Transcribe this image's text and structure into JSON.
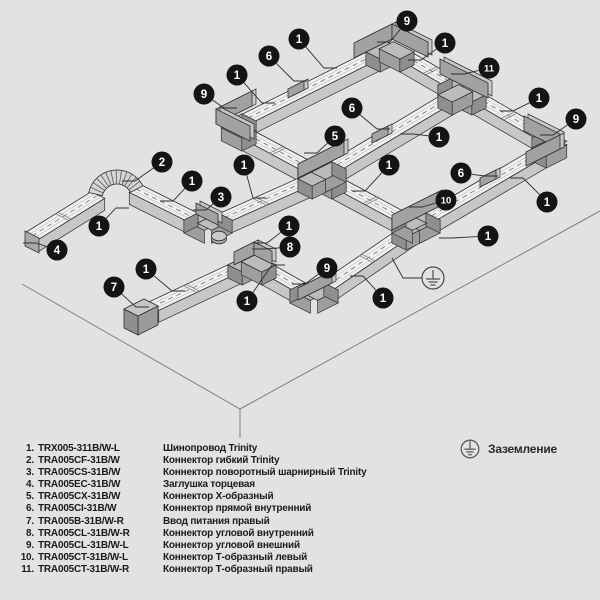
{
  "colors": {
    "bg": "#e2e2e0",
    "track_top": "#f0f0ee",
    "track_side": "#c7c7c5",
    "track_end": "#b2b2b0",
    "pad_top": "#bcbcba",
    "pad_side": "#9e9e9c",
    "pad_end": "#8f8f8d",
    "fin_front": "#a2a2a0",
    "fin_back": "#c8c8c6",
    "outline": "#2f2f2f",
    "dash": "#5e5e5c",
    "groove": "#aaaaa8",
    "plane_line": "#80807e",
    "callout_bg": "#141414",
    "callout_fg": "#ffffff",
    "ground_stroke": "#4a4a48",
    "legend_text": "#1b1b1b"
  },
  "diagram": {
    "plane": {
      "outline": [
        [
          22,
          284
        ],
        [
          240,
          409
        ],
        [
          600,
          211
        ]
      ],
      "vertical": [
        [
          240,
          409
        ],
        [
          240,
          438
        ]
      ]
    },
    "segments": [
      {
        "name": "ring-top-left",
        "from": [
          232,
          126
        ],
        "to": [
          390,
          47
        ],
        "dir": "B"
      },
      {
        "name": "ring-top-right",
        "from": [
          390,
          47
        ],
        "to": [
          556,
          143
        ],
        "dir": "A"
      },
      {
        "name": "ring-middle",
        "from": [
          322,
          174
        ],
        "to": [
          462,
          90
        ],
        "dir": "B"
      },
      {
        "name": "ring-bottom-right",
        "from": [
          416,
          225
        ],
        "to": [
          556,
          143
        ],
        "dir": "B"
      },
      {
        "name": "ring-bottom-left",
        "from": [
          232,
          126
        ],
        "to": [
          416,
          225
        ],
        "dir": "A"
      },
      {
        "name": "tail-left",
        "from": [
          32,
          236
        ],
        "to": [
          98,
          195
        ],
        "dir": "B"
      },
      {
        "name": "tail-mid",
        "from": [
          136,
          189
        ],
        "to": [
          208,
          225
        ],
        "dir": "A"
      },
      {
        "name": "tail-right",
        "from": [
          208,
          225
        ],
        "to": [
          322,
          174
        ],
        "dir": "B"
      },
      {
        "name": "chain-left",
        "from": [
          152,
          307
        ],
        "to": [
          252,
          260
        ],
        "dir": "B"
      },
      {
        "name": "chain-mid",
        "from": [
          252,
          260
        ],
        "to": [
          314,
          295
        ],
        "dir": "A"
      },
      {
        "name": "chain-right",
        "from": [
          314,
          295
        ],
        "to": [
          416,
          225
        ],
        "dir": "B"
      }
    ],
    "pads": [
      {
        "at": [
          232,
          126
        ],
        "dir": "B",
        "sign": 1
      },
      {
        "at": [
          232,
          126
        ],
        "dir": "A",
        "sign": 1
      },
      {
        "at": [
          390,
          47
        ],
        "dir": "B",
        "sign": -1
      },
      {
        "at": [
          390,
          47
        ],
        "dir": "A",
        "sign": 1
      },
      {
        "at": [
          556,
          143
        ],
        "dir": "A",
        "sign": -1
      },
      {
        "at": [
          556,
          143
        ],
        "dir": "B",
        "sign": -1
      },
      {
        "at": [
          462,
          90
        ],
        "dir": "A",
        "sign": -1
      },
      {
        "at": [
          462,
          90
        ],
        "dir": "A",
        "sign": 1
      },
      {
        "at": [
          462,
          90
        ],
        "dir": "B",
        "sign": -1
      },
      {
        "at": [
          416,
          225
        ],
        "dir": "B",
        "sign": -1
      },
      {
        "at": [
          416,
          225
        ],
        "dir": "B",
        "sign": 1
      },
      {
        "at": [
          416,
          225
        ],
        "dir": "A",
        "sign": -1
      },
      {
        "at": [
          322,
          174
        ],
        "dir": "A",
        "sign": -1
      },
      {
        "at": [
          322,
          174
        ],
        "dir": "A",
        "sign": 1
      },
      {
        "at": [
          322,
          174
        ],
        "dir": "B",
        "sign": -1
      },
      {
        "at": [
          322,
          174
        ],
        "dir": "B",
        "sign": 1
      },
      {
        "at": [
          252,
          260
        ],
        "dir": "B",
        "sign": -1
      },
      {
        "at": [
          252,
          260
        ],
        "dir": "A",
        "sign": 1
      },
      {
        "at": [
          314,
          295
        ],
        "dir": "A",
        "sign": -1
      },
      {
        "at": [
          314,
          295
        ],
        "dir": "B",
        "sign": 1
      },
      {
        "at": [
          208,
          225
        ],
        "dir": "A",
        "sign": -1
      },
      {
        "at": [
          208,
          225
        ],
        "dir": "B",
        "sign": 1
      }
    ],
    "fins": [
      [
        216,
        124,
        252,
        106,
        15
      ],
      [
        216,
        124,
        250,
        141,
        15
      ],
      [
        354,
        58,
        392,
        39,
        15
      ],
      [
        392,
        39,
        428,
        57,
        15
      ],
      [
        524,
        131,
        560,
        149,
        15
      ],
      [
        560,
        149,
        526,
        166,
        14
      ],
      [
        440,
        74,
        488,
        98,
        15
      ],
      [
        392,
        230,
        438,
        207,
        15
      ],
      [
        298,
        178,
        344,
        155,
        14
      ],
      [
        234,
        265,
        254,
        255,
        13
      ],
      [
        254,
        255,
        272,
        264,
        13
      ],
      [
        298,
        300,
        332,
        283,
        12
      ],
      [
        196,
        214,
        218,
        225,
        11
      ],
      [
        288,
        98,
        304,
        90,
        9
      ],
      [
        372,
        143,
        388,
        135,
        9
      ],
      [
        480,
        187,
        496,
        179,
        9
      ]
    ],
    "seams": [
      [
        276,
        150,
        "A"
      ],
      [
        370,
        200,
        "A"
      ],
      [
        430,
        70,
        "A"
      ],
      [
        508,
        115,
        "A"
      ],
      [
        533,
        156,
        "B"
      ],
      [
        366,
        259,
        "B"
      ],
      [
        260,
        202,
        "B"
      ],
      [
        190,
        289,
        "B"
      ],
      [
        62,
        217,
        "B"
      ]
    ],
    "flex": {
      "cx": 117,
      "cy": 199,
      "r": 22,
      "w": 7,
      "a1": 193,
      "a2": 333,
      "ribs": 13
    },
    "swivel_disk": {
      "cx": 219,
      "cy": 239,
      "rx": 7.5,
      "ry": 4.8
    },
    "endcap": [
      [
        25,
        231
      ],
      [
        39,
        238
      ],
      [
        39,
        253
      ],
      [
        25,
        246
      ]
    ],
    "feed_block": {
      "top": [
        [
          124,
          309
        ],
        [
          138,
          316
        ],
        [
          158,
          306
        ],
        [
          144,
          299
        ]
      ],
      "side": [
        [
          138,
          316
        ],
        [
          158,
          306
        ],
        [
          158,
          325
        ],
        [
          138,
          335
        ]
      ],
      "end": [
        [
          124,
          309
        ],
        [
          138,
          316
        ],
        [
          138,
          335
        ],
        [
          124,
          328
        ]
      ]
    },
    "ground_symbol": {
      "cx": 433,
      "cy": 278,
      "r": 11,
      "leader": [
        [
          422,
          278
        ],
        [
          403,
          278
        ],
        [
          392,
          258
        ]
      ]
    },
    "callouts": [
      {
        "n": "9",
        "c": [
          204,
          94
        ],
        "t": [
          224,
          108
        ]
      },
      {
        "n": "1",
        "c": [
          237,
          75
        ],
        "t": [
          262,
          103
        ]
      },
      {
        "n": "6",
        "c": [
          269,
          56
        ],
        "t": [
          294,
          81
        ]
      },
      {
        "n": "1",
        "c": [
          299,
          39
        ],
        "t": [
          324,
          68
        ]
      },
      {
        "n": "9",
        "c": [
          407,
          21
        ],
        "t": [
          390,
          42
        ]
      },
      {
        "n": "1",
        "c": [
          445,
          43
        ],
        "t": [
          421,
          60
        ]
      },
      {
        "n": "11",
        "c": [
          489,
          68
        ],
        "t": [
          464,
          74
        ]
      },
      {
        "n": "1",
        "c": [
          539,
          98
        ],
        "t": [
          513,
          111
        ]
      },
      {
        "n": "9",
        "c": [
          576,
          119
        ],
        "t": [
          553,
          135
        ]
      },
      {
        "n": "6",
        "c": [
          352,
          108
        ],
        "t": [
          377,
          129
        ]
      },
      {
        "n": "5",
        "c": [
          335,
          136
        ],
        "t": [
          317,
          153
        ]
      },
      {
        "n": "1",
        "c": [
          439,
          137
        ],
        "t": [
          413,
          134
        ]
      },
      {
        "n": "1",
        "c": [
          389,
          165
        ],
        "t": [
          365,
          191
        ]
      },
      {
        "n": "10",
        "c": [
          446,
          200
        ],
        "t": [
          422,
          207
        ]
      },
      {
        "n": "6",
        "c": [
          461,
          173
        ],
        "t": [
          485,
          176
        ]
      },
      {
        "n": "1",
        "c": [
          547,
          202
        ],
        "t": [
          523,
          178
        ]
      },
      {
        "n": "1",
        "c": [
          488,
          236
        ],
        "t": [
          452,
          238
        ]
      },
      {
        "n": "2",
        "c": [
          162,
          162
        ],
        "t": [
          135,
          181
        ]
      },
      {
        "n": "1",
        "c": [
          192,
          181
        ],
        "t": [
          173,
          201
        ]
      },
      {
        "n": "3",
        "c": [
          221,
          197
        ],
        "t": [
          206,
          210
        ]
      },
      {
        "n": "1",
        "c": [
          244,
          165
        ],
        "t": [
          253,
          198
        ]
      },
      {
        "n": "1",
        "c": [
          99,
          226
        ],
        "t": [
          116,
          208
        ]
      },
      {
        "n": "4",
        "c": [
          57,
          250
        ],
        "t": [
          36,
          243
        ]
      },
      {
        "n": "1",
        "c": [
          146,
          269
        ],
        "t": [
          172,
          291
        ]
      },
      {
        "n": "7",
        "c": [
          114,
          287
        ],
        "t": [
          136,
          307
        ]
      },
      {
        "n": "1",
        "c": [
          289,
          226
        ],
        "t": [
          267,
          243
        ]
      },
      {
        "n": "8",
        "c": [
          290,
          247
        ],
        "t": [
          265,
          249
        ]
      },
      {
        "n": "9",
        "c": [
          327,
          268
        ],
        "t": [
          305,
          284
        ]
      },
      {
        "n": "1",
        "c": [
          247,
          301
        ],
        "t": [
          272,
          265
        ]
      },
      {
        "n": "1",
        "c": [
          383,
          298
        ],
        "t": [
          363,
          276
        ]
      }
    ]
  },
  "legend": {
    "items": [
      {
        "num": "1.",
        "code": "TRX005-311B/W-L",
        "desc": "Шинопровод Trinity"
      },
      {
        "num": "2.",
        "code": "TRA005CF-31B/W",
        "desc": "Коннектор гибкий Trinity"
      },
      {
        "num": "3.",
        "code": "TRA005CS-31B/W",
        "desc": "Коннектор поворотный шарнирный Trinity"
      },
      {
        "num": "4.",
        "code": "TRA005EC-31B/W",
        "desc": "Заглушка торцевая"
      },
      {
        "num": "5.",
        "code": "TRA005CX-31B/W",
        "desc": "Коннектор Х-образный"
      },
      {
        "num": "6.",
        "code": "TRA005CI-31B/W",
        "desc": "Коннектор прямой внутренний"
      },
      {
        "num": "7.",
        "code": "TRA005B-31B/W-R",
        "desc": "Ввод питания правый"
      },
      {
        "num": "8.",
        "code": "TRA005CL-31B/W-R",
        "desc": "Коннектор угловой внутренний"
      },
      {
        "num": "9.",
        "code": "TRA005CL-31B/W-L",
        "desc": "Коннектор угловой внешний"
      },
      {
        "num": "10.",
        "code": "TRA005CT-31B/W-L",
        "desc": "Коннектор Т-образный левый"
      },
      {
        "num": "11.",
        "code": "TRA005CT-31B/W-R",
        "desc": "Коннектор Т-образный правый"
      }
    ],
    "ground_label": "Заземление"
  }
}
